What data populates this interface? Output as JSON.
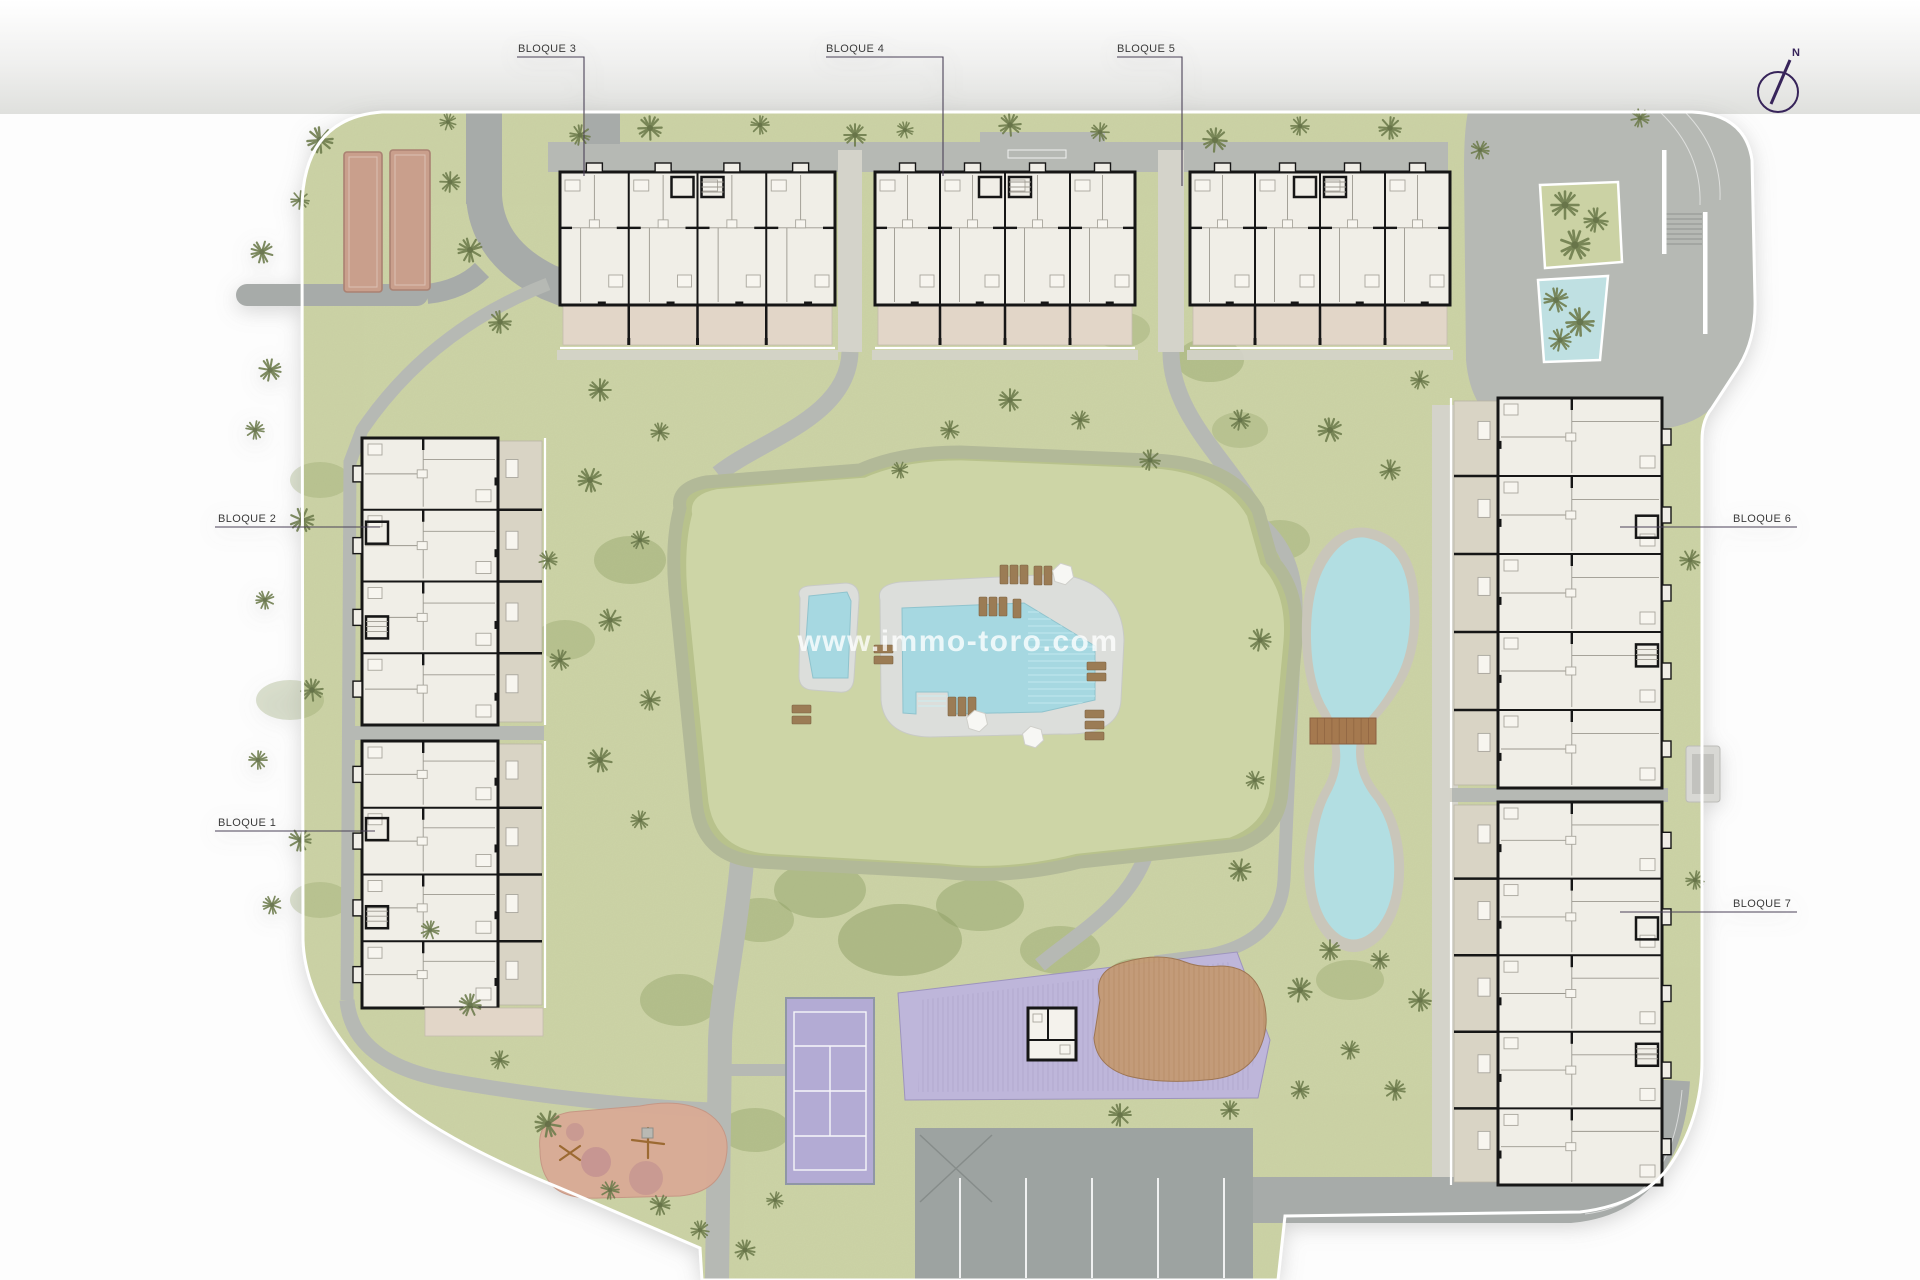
{
  "labels": {
    "bloque1": "BLOQUE 1",
    "bloque2": "BLOQUE 2",
    "bloque3": "BLOQUE 3",
    "bloque4": "BLOQUE 4",
    "bloque5": "BLOQUE 5",
    "bloque6": "BLOQUE 6",
    "bloque7": "BLOQUE 7"
  },
  "compass": {
    "north_label": "N"
  },
  "watermark": {
    "text": "www.immo-toro.com"
  },
  "colors": {
    "grass": "#cbd2a4",
    "grassDark": "#8fa065",
    "tree": "#6f7d4e",
    "mound": "#b8c28c",
    "moundTop": "#cdd5a6",
    "moundRing": "#b2b998",
    "path": "#b6b9b4",
    "road": "#a7aba9",
    "gravel": "#d4d3ca",
    "deck": "#dcdedb",
    "water": "#a6d8e1",
    "pond": "#b2dee2",
    "stone": "#c9c6ba",
    "purple": "#beb6da",
    "court": "#b3abd4",
    "slat": "#a79dc6",
    "brownDeck": "#c49b76",
    "parking": "#9da3a1",
    "playground": "#d9ab96",
    "playEquip": "#c08d90",
    "lounger": "#9b7c54",
    "petanque": "#c99f8c",
    "petanqueEdge": "#aa8172",
    "bfill": "#f0eee7",
    "wall": "#161616",
    "terrace": "#d9d4c5",
    "terracePink": "#e2d6c8",
    "label": "#3a3a3a",
    "line": "#4c4258",
    "compassCol": "#37245a",
    "wm": "#ffffff",
    "bridge": "#a5794f"
  }
}
